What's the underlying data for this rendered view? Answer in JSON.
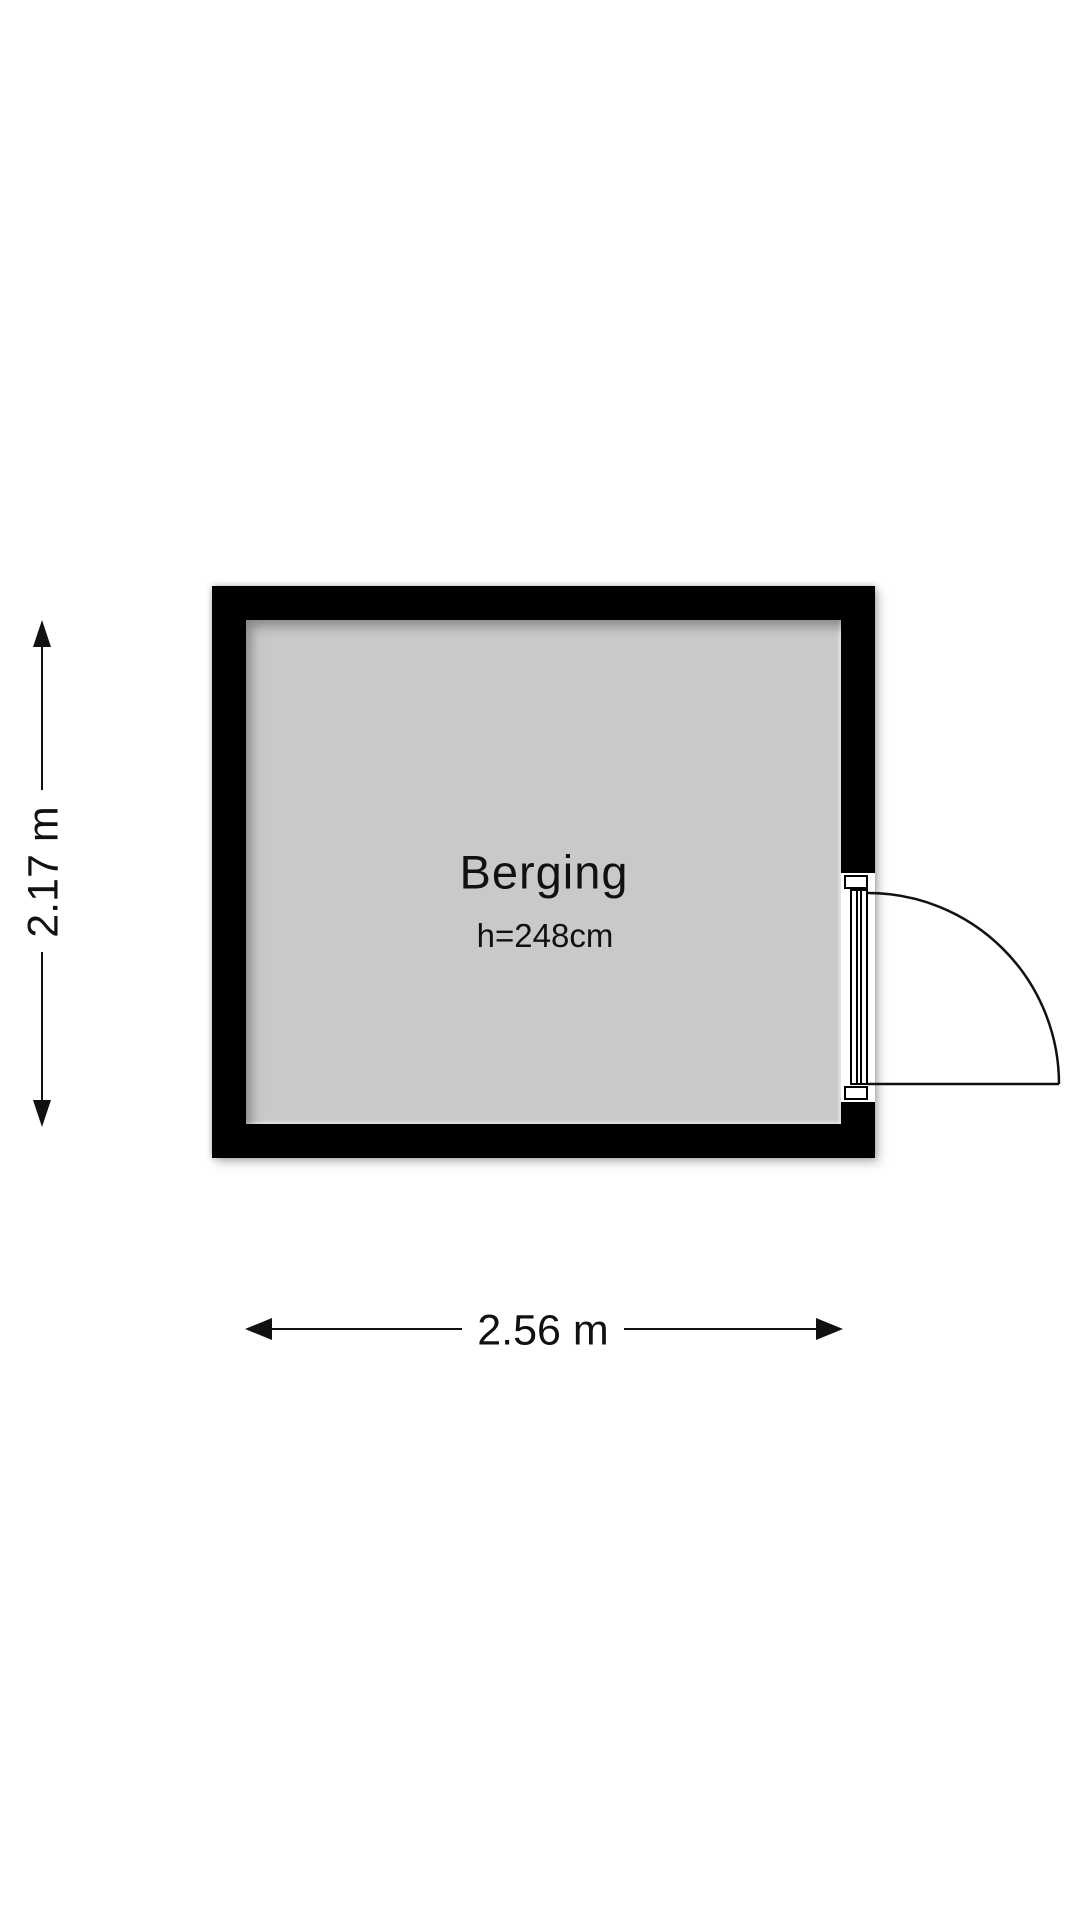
{
  "floorplan": {
    "room": {
      "name": "Berging",
      "ceiling_height": "h=248cm"
    },
    "dimensions": {
      "height": {
        "label": "2.17 m"
      },
      "width": {
        "label": "2.56 m"
      }
    },
    "colors": {
      "wall": "#000000",
      "floor": "#c9c9c9",
      "line": "#111111",
      "background": "#ffffff"
    }
  }
}
